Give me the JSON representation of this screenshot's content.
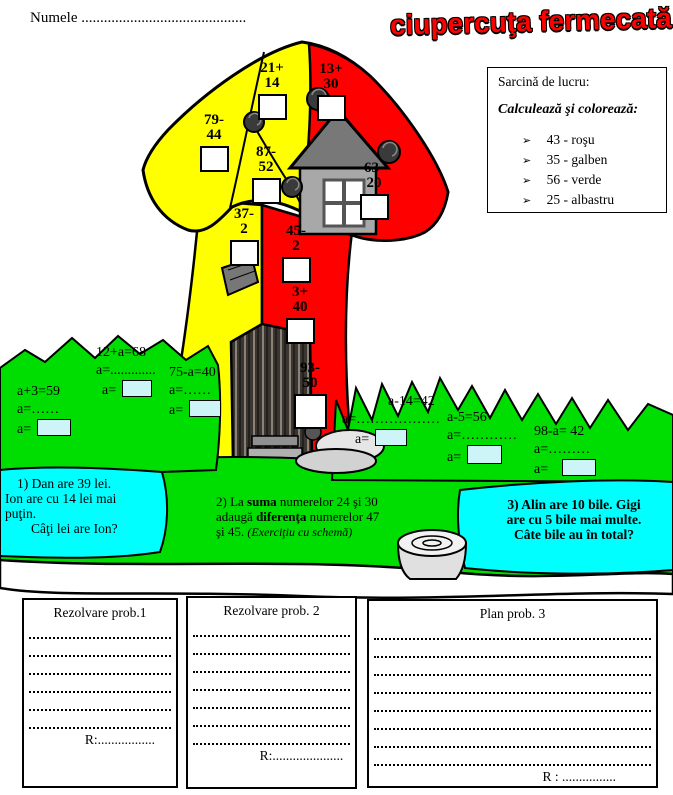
{
  "colors": {
    "red": "#ff0000",
    "yellow": "#ffff00",
    "green": "#00dd00",
    "cyan": "#00ffff",
    "house_wall": "#a8a8a8",
    "house_roof": "#787878",
    "cabin_dark": "#3c3630",
    "rock_gray": "#e6e6e6",
    "answer_box": "#ffffff",
    "equation_box": "#cdf4f6",
    "title": "#ff0000"
  },
  "header": {
    "name_label": "Numele",
    "name_dots": "............................................",
    "title": "ciupercuţa fermecată"
  },
  "task_box": {
    "heading": "Sarcină de lucru:",
    "subheading": "Calculează şi colorează:",
    "bullet": "➢",
    "legend": [
      {
        "label": "43 - roşu",
        "hex": "#ff0000"
      },
      {
        "label": "35 - galben",
        "hex": "#ffff00"
      },
      {
        "label": "56 - verde",
        "hex": "#00dd00"
      },
      {
        "label": "25 - albastru",
        "hex": "#00ffff"
      }
    ]
  },
  "exercises": [
    {
      "top": "21+",
      "bottom": "14",
      "region": "cap-yellow"
    },
    {
      "top": "79-",
      "bottom": "44",
      "region": "cap-yellow"
    },
    {
      "top": "87-",
      "bottom": "52",
      "region": "cap-yellow"
    },
    {
      "top": "13+",
      "bottom": "30",
      "region": "cap-red"
    },
    {
      "top": "63-",
      "bottom": "20",
      "region": "cap-red"
    },
    {
      "top": "37-",
      "bottom": "2",
      "region": "stem-yellow"
    },
    {
      "top": "45-",
      "bottom": "2",
      "region": "stem-red"
    },
    {
      "top": "3+",
      "bottom": "40",
      "region": "stem-red"
    },
    {
      "top": "93-",
      "bottom": "50",
      "region": "stem-red"
    }
  ],
  "equations": [
    {
      "eq": "a+3=59",
      "work": "a=……",
      "ans": "a="
    },
    {
      "eq": "12+a=68",
      "work": "a=.............",
      "ans": "a="
    },
    {
      "eq": "75-a=40",
      "work": "a=……",
      "ans": "a="
    },
    {
      "eq": "a-14=42",
      "work": "a=………………",
      "ans": "a="
    },
    {
      "eq": "a-5=56",
      "work": "a=…………",
      "ans": "a="
    },
    {
      "eq": "98-a= 42",
      "work": "a=………",
      "ans": "a="
    }
  ],
  "problems": {
    "p1": {
      "l1": "1)   Dan are 39 lei.",
      "l2": "Ion are cu 14 lei mai",
      "l3": "puţin.",
      "l4": "Câţi lei are Ion?"
    },
    "p2": {
      "pre1": "2)   La ",
      "bold1": "suma",
      "post1": " numerelor 24 şi 30",
      "pre2": "adaugă ",
      "bold2": "diferenţa",
      "post2": " numerelor 47",
      "pre3": "şi 45. ",
      "note": "(Exerciţiu cu schemă)"
    },
    "p3": {
      "l1": "3) Alin are 10 bile. Gigi",
      "l2": "are cu 5 bile mai multe.",
      "l3": "Câte bile au în total?"
    }
  },
  "answer_sections": [
    {
      "title": "Rezolvare prob.1",
      "r": "R:................."
    },
    {
      "title": "Rezolvare prob. 2",
      "r": "R:....................."
    },
    {
      "title": "Plan prob. 3",
      "r": "R : ................"
    }
  ]
}
